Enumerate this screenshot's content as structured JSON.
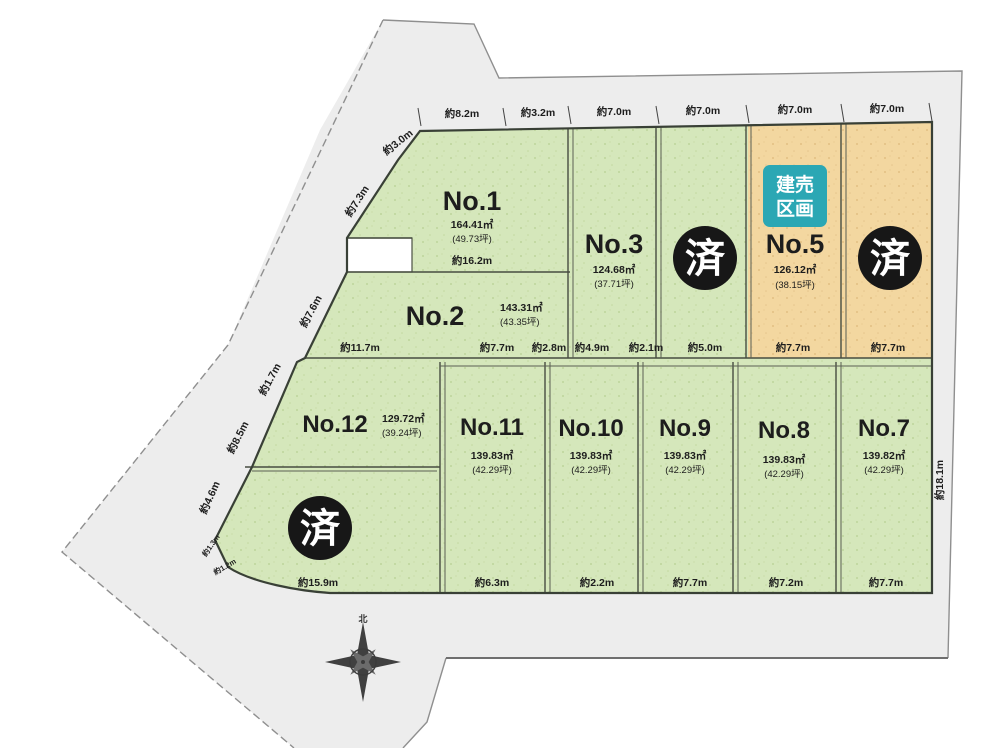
{
  "sold_mark": "済",
  "badge": {
    "line1": "建売",
    "line2": "区画"
  },
  "north_label": "北",
  "plots": [
    {
      "name": "No.1",
      "area": "164.41㎡",
      "tsubo": "(49.73坪)"
    },
    {
      "name": "No.2",
      "area": "143.31㎡",
      "tsubo": "(43.35坪)"
    },
    {
      "name": "No.3",
      "area": "124.68㎡",
      "tsubo": "(37.71坪)"
    },
    {
      "name": "No.5",
      "area": "126.12㎡",
      "tsubo": "(38.15坪)"
    },
    {
      "name": "No.7",
      "area": "139.82㎡",
      "tsubo": "(42.29坪)"
    },
    {
      "name": "No.8",
      "area": "139.83㎡",
      "tsubo": "(42.29坪)"
    },
    {
      "name": "No.9",
      "area": "139.83㎡",
      "tsubo": "(42.29坪)"
    },
    {
      "name": "No.10",
      "area": "139.83㎡",
      "tsubo": "(42.29坪)"
    },
    {
      "name": "No.11",
      "area": "139.83㎡",
      "tsubo": "(42.29坪)"
    },
    {
      "name": "No.12",
      "area": "129.72㎡",
      "tsubo": "(39.24坪)"
    }
  ],
  "dims": {
    "top": [
      "約8.2m",
      "約3.2m",
      "約7.0m",
      "約7.0m",
      "約7.0m",
      "約7.0m"
    ],
    "left": [
      "約3.0m",
      "約7.3m",
      "約7.6m",
      "約1.7m",
      "約8.5m",
      "約4.6m",
      "約1.3m",
      "約1.2m"
    ],
    "right": "約18.1m",
    "no1_inner": "約16.2m",
    "mid": [
      "約11.7m",
      "約7.7m",
      "約2.8m",
      "約4.9m",
      "約2.1m",
      "約5.0m",
      "約7.7m",
      "約7.7m"
    ],
    "bottom": [
      "約15.9m",
      "約6.3m",
      "約2.2m",
      "約7.7m",
      "約7.2m",
      "約7.7m"
    ]
  },
  "colors": {
    "green_plot": "#d5e7bb",
    "orange_plot": "#f3d7a0",
    "road": "#ededed",
    "sold_circle": "#171717",
    "badge_teal": "#2ba7b4"
  }
}
